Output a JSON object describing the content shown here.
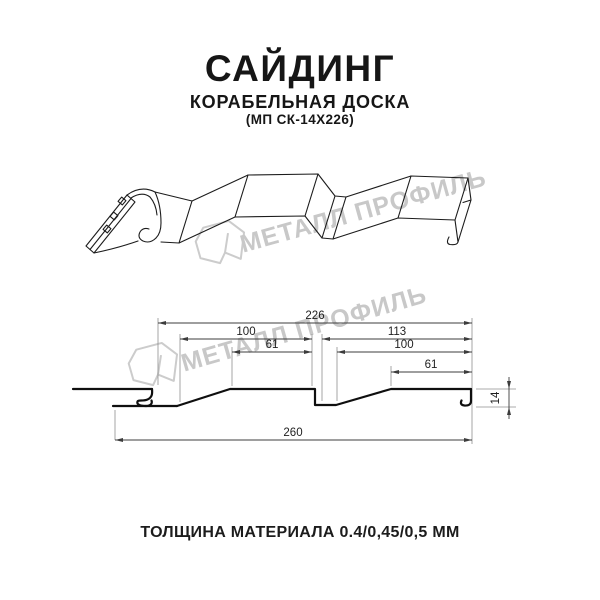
{
  "header": {
    "title": "САЙДИНГ",
    "subtitle": "КОРАБЕЛЬНАЯ ДОСКА",
    "model_code": "(МП СК-14Х226)"
  },
  "watermark": {
    "brand": "МЕТАЛЛ ПРОФИЛЬ",
    "color": "#c8c8c8"
  },
  "cross_section": {
    "dim_226": "226",
    "dim_100_left": "100",
    "dim_61_left": "61",
    "dim_113": "113",
    "dim_100_right": "100",
    "dim_61_right": "61",
    "dim_260": "260",
    "dim_14": "14"
  },
  "footer": {
    "thickness_note": "ТОЛЩИНА МАТЕРИАЛА 0.4/0,45/0,5 ММ"
  }
}
